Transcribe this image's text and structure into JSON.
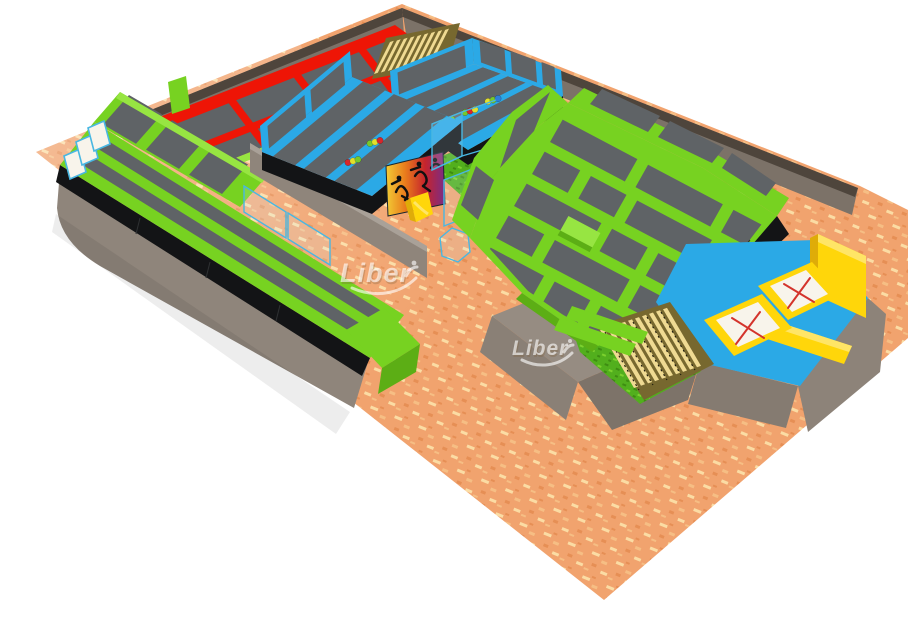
{
  "watermark": {
    "text": "Liber",
    "count": 2
  },
  "palette": {
    "floor_base": "#F1A36E",
    "floor_speck_light": "#FBDCA4",
    "floor_speck_mid": "#F6BE84",
    "floor_speck_dark": "#E68F55",
    "wall_light": "#8F857B",
    "wall_mid": "#7C7268",
    "wall_dark": "#6A6157",
    "wall_top": "#4E453C",
    "frame_green": "#77D221",
    "frame_green_dark": "#5CAE15",
    "frame_green_light": "#97E542",
    "red": "#EE1506",
    "red_dark": "#BE1004",
    "blue": "#2BA9E6",
    "blue_dark": "#1F86BE",
    "blue_light": "#5BC4F2",
    "yellow": "#FFD60A",
    "yellow_dark": "#DFAC08",
    "yellow_light": "#FFE566",
    "mat_gray": "#5F6366",
    "mat_gray_dark": "#52565A",
    "black_pad": "#131416",
    "black_line": "#2E3032",
    "tan_slat": "#EFDA92",
    "tan_dark": "#77682F",
    "grass": "#52AF1D",
    "grass_dark": "#3E8C12",
    "grass_light": "#7CD12E",
    "white_mat": "#F8F4EB",
    "x_red": "#D4342C",
    "glass_blue": "#49B7E2",
    "ball_red": "#D8262B",
    "ball_yellow": "#E3DF2D",
    "ball_green": "#77C82C",
    "ball_blue": "#2F7FD6",
    "mural_yellow": "#F2CC35",
    "mural_orange": "#E97B1C",
    "mural_red": "#C6242C",
    "mural_purple": "#7A2C86",
    "watermark_fill": "rgba(255,255,255,0.62)",
    "watermark_shadow": "rgba(125,95,60,0.30)"
  },
  "scene": {
    "zones": [
      {
        "name": "textured-floor",
        "color": "#F1A36E"
      },
      {
        "name": "perimeter-back-wall",
        "color": "#7C7268"
      },
      {
        "name": "red-free-jump-court",
        "color": "#EE1506"
      },
      {
        "name": "top-wood-slat-area",
        "color": "#EFDA92"
      },
      {
        "name": "wall-trampoline-runway",
        "color": "#77D221"
      },
      {
        "name": "dodgeball-court-1",
        "color": "#2BA9E6"
      },
      {
        "name": "dodgeball-court-2",
        "color": "#2BA9E6"
      },
      {
        "name": "grass-corridor-with-glass-fence",
        "color": "#52AF1D"
      },
      {
        "name": "mural-panel",
        "color": "#E97B1C"
      },
      {
        "name": "kids-slide",
        "color": "#FFD60A"
      },
      {
        "name": "basketball-dunk-hoop",
        "color": "#2BA9E6"
      },
      {
        "name": "main-green-trampoline-court",
        "color": "#77D221"
      },
      {
        "name": "blue-foam-zone",
        "color": "#2BA9E6"
      },
      {
        "name": "performance-trampolines-with-x",
        "color": "#F8F4EB"
      },
      {
        "name": "bleacher-slat-stairs",
        "color": "#EFDA92"
      },
      {
        "name": "gray-base-plinth",
        "color": "#8F857B"
      }
    ],
    "ball_colors": [
      "#D8262B",
      "#E3DF2D",
      "#77C82C",
      "#2F7FD6"
    ]
  }
}
